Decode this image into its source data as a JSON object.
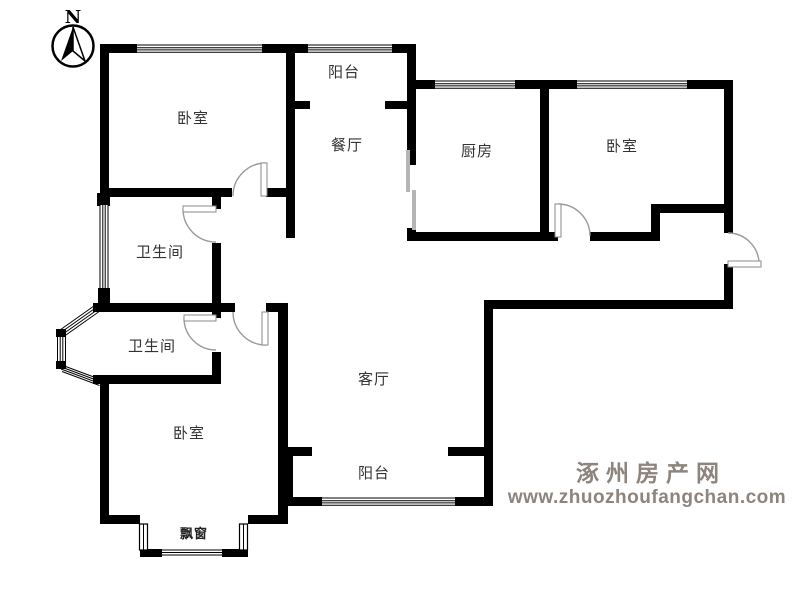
{
  "compass": {
    "north_label": "N"
  },
  "rooms": {
    "bedroom_top_left": {
      "label": "卧室"
    },
    "balcony_top": {
      "label": "阳台"
    },
    "dining_room": {
      "label": "餐厅"
    },
    "kitchen": {
      "label": "厨房"
    },
    "bedroom_top_right": {
      "label": "卧室"
    },
    "bathroom_upper": {
      "label": "卫生间"
    },
    "bathroom_lower": {
      "label": "卫生间"
    },
    "living_room": {
      "label": "客厅"
    },
    "balcony_bottom": {
      "label": "阳台"
    },
    "bedroom_bottom": {
      "label": "卧室"
    },
    "bay_window": {
      "label": "飘窗"
    }
  },
  "watermark": {
    "site_name": "涿州房产网",
    "site_url": "www.zhuozhoufangchan.com"
  },
  "colors": {
    "wall": "#000000",
    "door_arc": "#9a9a9a",
    "watermark": "#8d857d",
    "background": "#ffffff"
  }
}
